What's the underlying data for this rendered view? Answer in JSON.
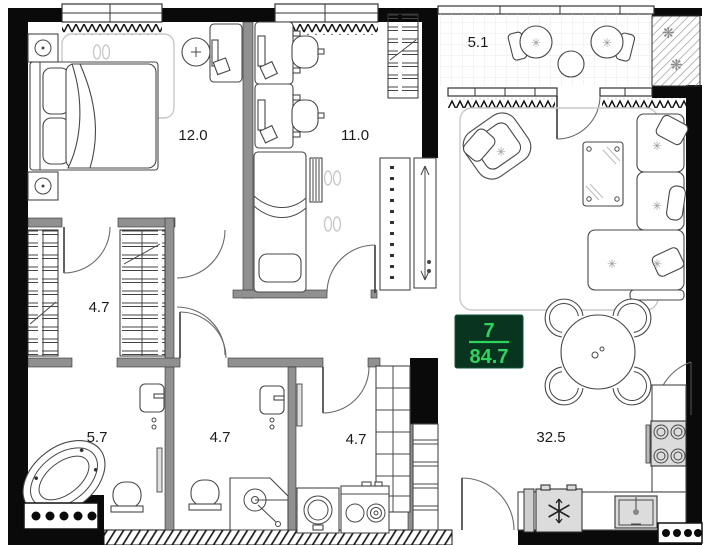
{
  "floor_plan": {
    "badge": {
      "top_value": "7",
      "bottom_value": "84.7"
    },
    "room_labels": {
      "bedroom": "12.0",
      "office": "11.0",
      "balcony": "5.1",
      "closet": "4.7",
      "bathroom": "5.7",
      "shower_room": "4.7",
      "laundry": "4.7",
      "living_kitchen": "32.5"
    },
    "icons": {
      "decor": "✳",
      "plant": "❋"
    },
    "colors": {
      "wall_black": "#0a0a0a",
      "partition_gray": "#909090",
      "badge_background": "#083420",
      "badge_green": "#2fd45c",
      "furniture_line": "#474747",
      "rug_line": "#c9c9c9",
      "appliance_gray": "#dcdcdc"
    }
  }
}
